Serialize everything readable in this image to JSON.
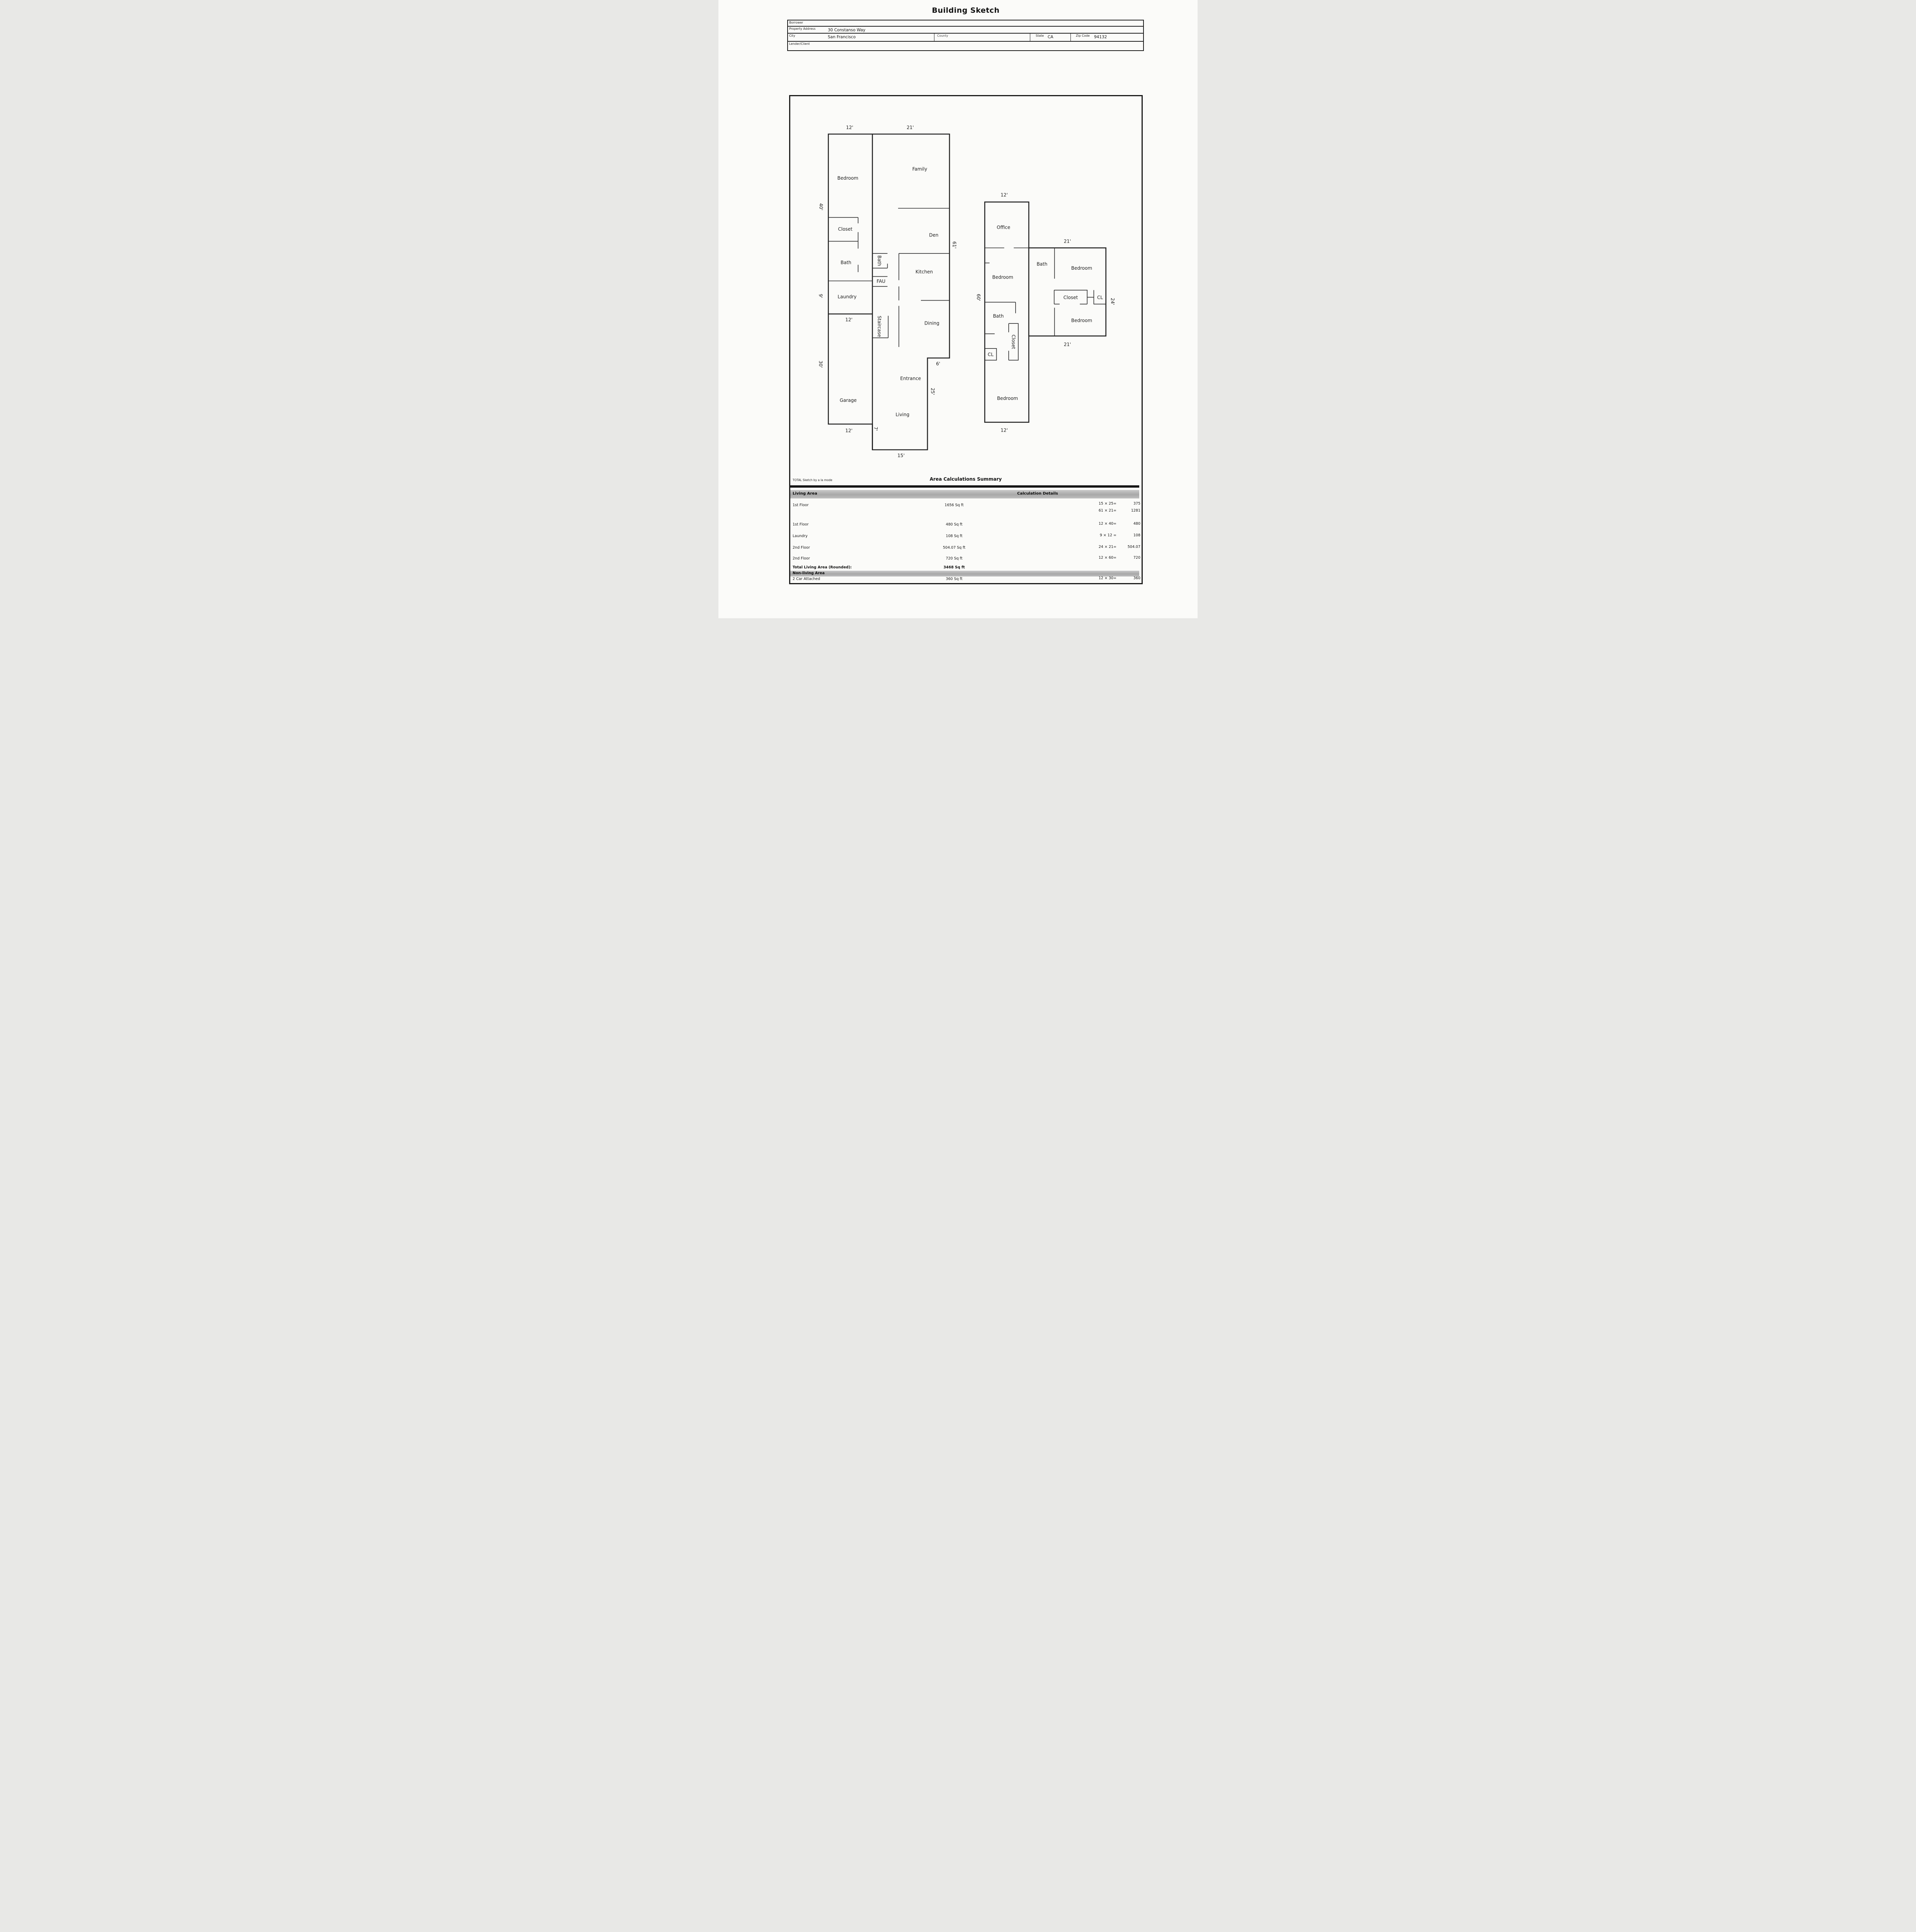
{
  "title": "Building Sketch",
  "header": {
    "borrower_label": "Borrower",
    "property_label": "Property Address",
    "property_value": "30 Constanso Way",
    "city_label": "City",
    "city_value": "San Francisco",
    "county_label": "County",
    "state_label": "State",
    "state_value": "CA",
    "zip_label": "Zip Code",
    "zip_value": "94132",
    "lender_label": "Lender/Client"
  },
  "floorplan": {
    "rooms": {
      "a_bedroom": "Bedroom",
      "a_family": "Family",
      "a_closet": "Closet",
      "a_den": "Den",
      "a_bath": "Bath",
      "a_bath2": "Bath",
      "a_kitchen": "Kitchen",
      "a_laundry": "Laundry",
      "a_fau": "FAU",
      "a_staircase": "Staircase",
      "a_dining": "Dining",
      "a_entrance": "Entrance",
      "a_garage": "Garage",
      "a_living": "Living",
      "b_office": "Office",
      "b_bedroom1": "Bedroom",
      "b_bath1": "Bath",
      "b_closet1": "Closet",
      "b_cl1": "CL",
      "b_bedroom2": "Bedroom",
      "c_bath": "Bath",
      "c_bedroom1": "Bedroom",
      "c_closet": "Closet",
      "c_cl": "CL",
      "c_bedroom2": "Bedroom"
    },
    "dims": {
      "a_top_12": "12'",
      "a_top_21": "21'",
      "a_left_40": "40'",
      "a_right_61": "61'",
      "a_left_9": "9'",
      "a_mid_12": "12'",
      "a_left_30": "30'",
      "a_6": "6'",
      "a_right_25": "25'",
      "a_7": "7'",
      "a_garage_12": "12'",
      "a_bottom_15": "15'",
      "b_top_12": "12'",
      "b_left_60": "60'",
      "b_bottom_12": "12'",
      "c_top_21": "21'",
      "c_right_24": "24'",
      "c_bottom_21": "21'"
    }
  },
  "summary": {
    "branding": "TOTAL Sketch by a la mode",
    "heading": "Area Calculations Summary",
    "living_header": "Living Area",
    "calc_header": "Calculation Details",
    "living_rows": [
      {
        "name": "1st Floor",
        "area": "1656 Sq ft",
        "calcs": [
          {
            "expr": "15 × 25=",
            "val": "375"
          },
          {
            "expr": "61 × 21=",
            "val": "1281"
          }
        ]
      },
      {
        "name": "1st Floor",
        "area": "480 Sq ft",
        "calcs": [
          {
            "expr": "12 × 40=",
            "val": "480"
          }
        ]
      },
      {
        "name": "Laundry",
        "area": "108 Sq ft",
        "calcs": [
          {
            "expr": "9 × 12 =",
            "val": "108"
          }
        ]
      },
      {
        "name": "2nd Floor",
        "area": "504.07 Sq ft",
        "calcs": [
          {
            "expr": "24 × 21=",
            "val": "504.07"
          }
        ]
      },
      {
        "name": "2nd Floor",
        "area": "720 Sq ft",
        "calcs": [
          {
            "expr": "12 × 60=",
            "val": "720"
          }
        ]
      }
    ],
    "total_label": "Total Living Area (Rounded):",
    "total_value": "3468 Sq ft",
    "nonliving_header": "Non-living Area",
    "nonliving_rows": [
      {
        "name": "2 Car Attached",
        "area": "360 Sq ft",
        "calcs": [
          {
            "expr": "12 × 30=",
            "val": "360"
          }
        ]
      }
    ]
  }
}
